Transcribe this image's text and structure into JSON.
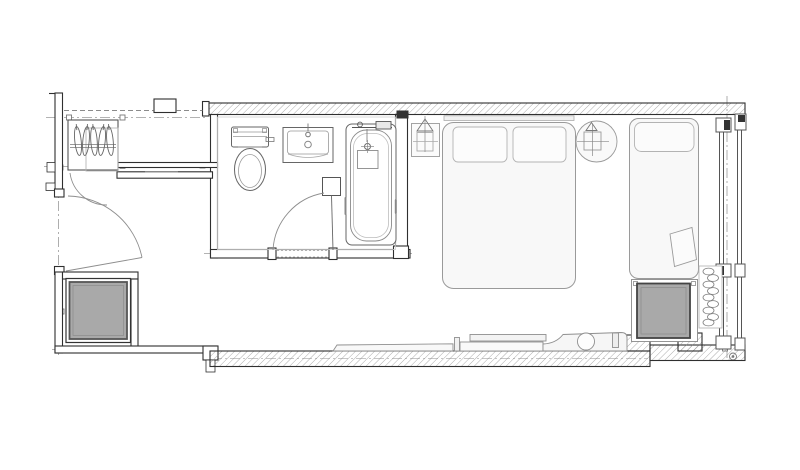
{
  "drawing": {
    "type": "architectural-floor-plan",
    "background": "#ffffff",
    "colors": {
      "wall_line": "#2f2f2f",
      "hatch_line": "#8a8a8a",
      "fixture_line": "#9a9a9a",
      "sanitary_line": "#666666",
      "centerline": "#9a9a9a",
      "column_fill": "#a9a9a9",
      "furniture_fill": "#f7f7f7"
    },
    "rooms": {
      "entry": "Entry hall",
      "bathroom": "Bathroom",
      "bedroom": "Bedroom"
    },
    "fixtures": {
      "wardrobe": "Wardrobe with coat hangers",
      "entry_door": "Entry door swing",
      "closet_door": "Closet door swing",
      "toilet": "Toilet",
      "washbasin": "Washbasin vanity",
      "bathtub": "Bathtub with fittings",
      "bathroom_door": "Bathroom door swing",
      "double_bed": "Double bed with two pillows",
      "nightstand_left": "Nightstand with pendant lamp symbol",
      "nightstand_right": "Round nightstand with pendant lamp symbol",
      "daybed": "Daybed with pillow",
      "cushion": "Throw cushion",
      "bench": "Low bench, shelf and lounge chair",
      "column_left": "Structural column (shaded)",
      "column_right": "Structural column (shaded)",
      "curtain": "Curtain coil symbol",
      "window": "Glazed window wall"
    }
  }
}
